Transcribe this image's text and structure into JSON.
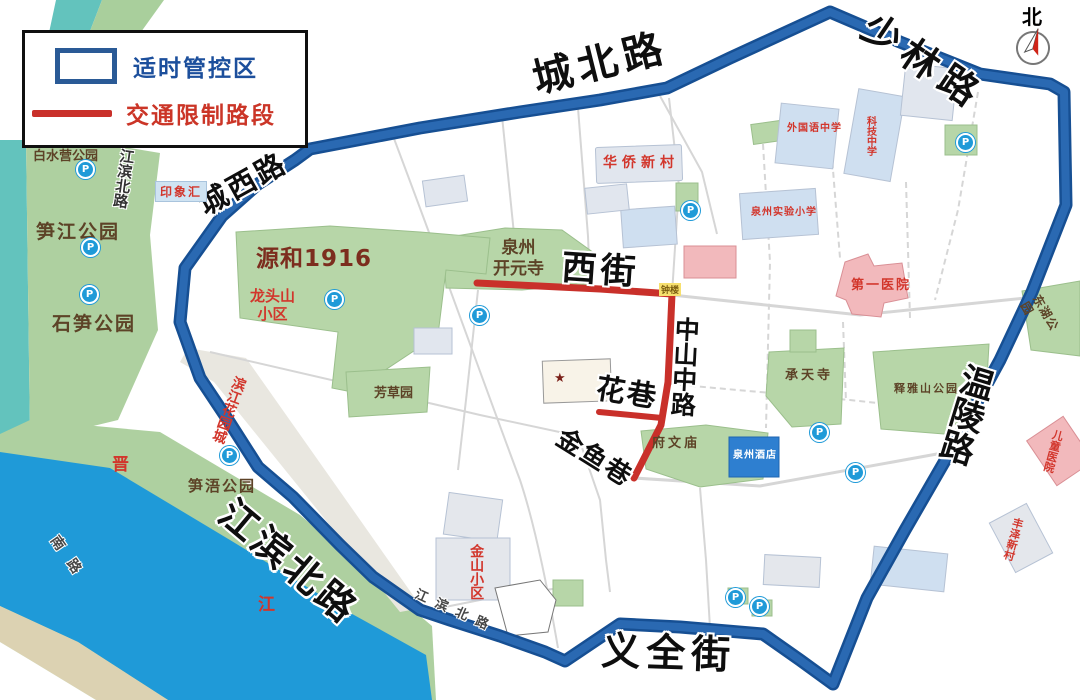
{
  "legend": {
    "control_zone_label": "适时管控区",
    "restricted_label": "交通限制路段"
  },
  "compass": {
    "north_label": "北"
  },
  "roads": {
    "chengbei": "城北路",
    "shaolin": "少林路",
    "chengxi": "城西路",
    "wenling": "温陵路",
    "yiquan": "义全街",
    "jiangbin_north": "江滨北路",
    "jiangbin_north_vertical": "江滨北路",
    "jiangbin_north_bottom": "江滨北路",
    "jiangbin_south_partial": "南路",
    "xijie": "西街",
    "zhongshan_middle": "中山中路",
    "huaxiang": "花巷",
    "jinyu_xiang": "金鱼巷"
  },
  "parks": {
    "baishuiying": "白水营公园",
    "sunjiang": "笋江公园",
    "shisun": "石笋公园",
    "sunwu": "笋浯公园",
    "fangcao": "芳草园",
    "kaiyuan_temple": "泉州\n开元寺",
    "fuwenmiao": "府文庙",
    "chengtian_temple": "承天寺",
    "shiyashan": "释雅山公园",
    "donghu": "东湖公园"
  },
  "places": {
    "yuanhe_1916": "源和1916",
    "longtoushan": "龙头山\n小区",
    "yinxianghui": "印象汇",
    "huaqiao_xincun": "华侨新村",
    "waiguoyu_school": "外国语中学",
    "keji_school": "科技中学",
    "shiyan_school": "泉州实验小学",
    "zhonglou": "钟楼",
    "diyi_hospital": "第一医院",
    "ertong_hospital": "儿童医院",
    "fengze_xincun": "丰泽新村",
    "quanzhou_hotel": "泉州酒店",
    "jinshan_xiaoqu": "金山小区",
    "binjiang_garden": "滨江花园城"
  },
  "river": {
    "jin_char": "晋",
    "jiang_char": "江"
  },
  "icons": {
    "parking_letter": "P",
    "star": "★"
  },
  "colors": {
    "boundary_blue": "#1d5ba4",
    "restricted_red": "#c9302a",
    "river_blue": "#1f9ad8",
    "park_green": "#aed0a0",
    "label_red": "#d2362c",
    "legend_blue": "#1c4f9c"
  }
}
